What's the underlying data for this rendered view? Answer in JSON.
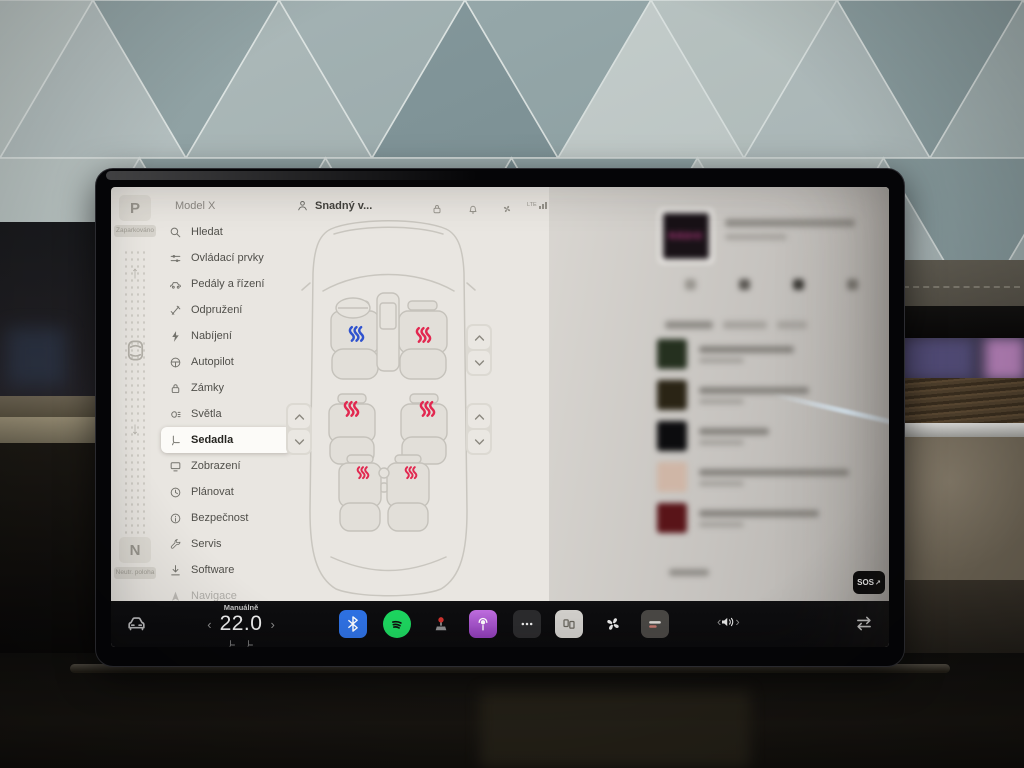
{
  "gear_strip": {
    "park_label": "P",
    "park_caption": "Zaparkováno",
    "neutral_label": "N",
    "neutral_caption": "Neutr. poloha",
    "up_arrow": "↑",
    "down_arrow": "↓"
  },
  "sidebar": {
    "title": "Model X",
    "items": [
      {
        "label": "Hledat",
        "icon": "search-icon"
      },
      {
        "label": "Ovládací prvky",
        "icon": "controls-icon"
      },
      {
        "label": "Pedály a řízení",
        "icon": "pedals-icon"
      },
      {
        "label": "Odpružení",
        "icon": "suspension-icon"
      },
      {
        "label": "Nabíjení",
        "icon": "charging-icon"
      },
      {
        "label": "Autopilot",
        "icon": "steering-wheel-icon"
      },
      {
        "label": "Zámky",
        "icon": "lock-icon"
      },
      {
        "label": "Světla",
        "icon": "lights-icon"
      },
      {
        "label": "Sedadla",
        "icon": "seat-icon",
        "selected": true
      },
      {
        "label": "Zobrazení",
        "icon": "display-icon"
      },
      {
        "label": "Plánovat",
        "icon": "schedule-icon"
      },
      {
        "label": "Bezpečnost",
        "icon": "safety-icon"
      },
      {
        "label": "Servis",
        "icon": "service-icon"
      },
      {
        "label": "Software",
        "icon": "software-icon"
      },
      {
        "label": "Navigace",
        "icon": "navigation-icon",
        "faded": true
      }
    ]
  },
  "header": {
    "profile_label": "Snadný v...",
    "status_icons": [
      "lock-icon",
      "bell-icon",
      "fan-icon"
    ],
    "network_label": "LTE"
  },
  "seatmap": {
    "seats": [
      {
        "id": "front-left",
        "heat": "blue"
      },
      {
        "id": "front-right",
        "heat": "red"
      },
      {
        "id": "middle-left",
        "heat": "red"
      },
      {
        "id": "middle-right",
        "heat": "red"
      },
      {
        "id": "rear-left",
        "heat": "red"
      },
      {
        "id": "rear-right",
        "heat": "red"
      }
    ],
    "heat_red": "#e22850",
    "heat_blue": "#3053cf"
  },
  "media": {
    "album_text": "RÁDIO",
    "sos_label": "SOS",
    "sos_arrow": "↗",
    "thumbs": [
      "#25301f",
      "#2a2415",
      "#0c0c0e",
      "#cfb6a6",
      "#591418"
    ],
    "title_widths": [
      95,
      110,
      70,
      150,
      120
    ]
  },
  "climate": {
    "mode_label": "Manuálně",
    "temperature": "22.0",
    "left_chevron": "‹",
    "right_chevron": "›"
  },
  "volume": {
    "left_chevron": "‹",
    "right_chevron": "›"
  },
  "bottom_bar": {
    "apps": [
      "bluetooth",
      "spotify",
      "arcade",
      "podcasts",
      "more",
      "theater",
      "fan",
      "radio"
    ]
  },
  "colors": {
    "spotify_green": "#1ed760",
    "bluetooth_blue": "#2f72e4",
    "podcasts_purple": "#a855cf",
    "accent_red": "#e22850",
    "accent_blue": "#3053cf"
  }
}
